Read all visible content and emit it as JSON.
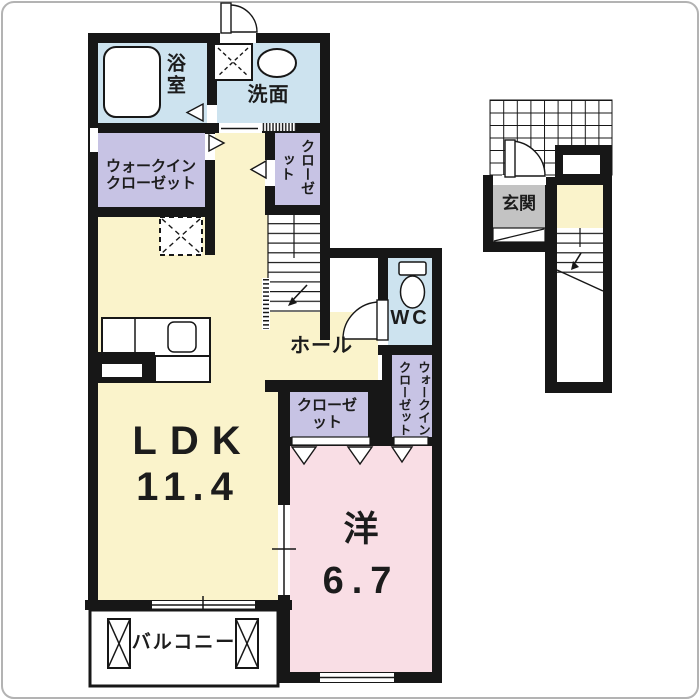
{
  "rooms": {
    "ldk_name": "LDK",
    "ldk_size": "11.4",
    "western_name": "洋",
    "western_size": "6.7",
    "balcony": "バルコニー",
    "hall": "ホール",
    "wc": "WC",
    "entrance": "玄関",
    "bath": "浴室",
    "washroom": "洗面",
    "walk_in_closet_left": "ウォークインクローゼット",
    "closet_upper": "クローゼット",
    "closet_lower": "クローゼット",
    "walk_in_closet_right": "ウォークインクローゼット"
  },
  "colors": {
    "floor_yellow": "#FAF3CB",
    "floor_pink": "#F9DEE5",
    "closet_purple": "#C7C3E4",
    "wet_area_blue": "#CDE3EF",
    "entrance_gray": "#C3C3C3",
    "wall_black": "#171717"
  }
}
